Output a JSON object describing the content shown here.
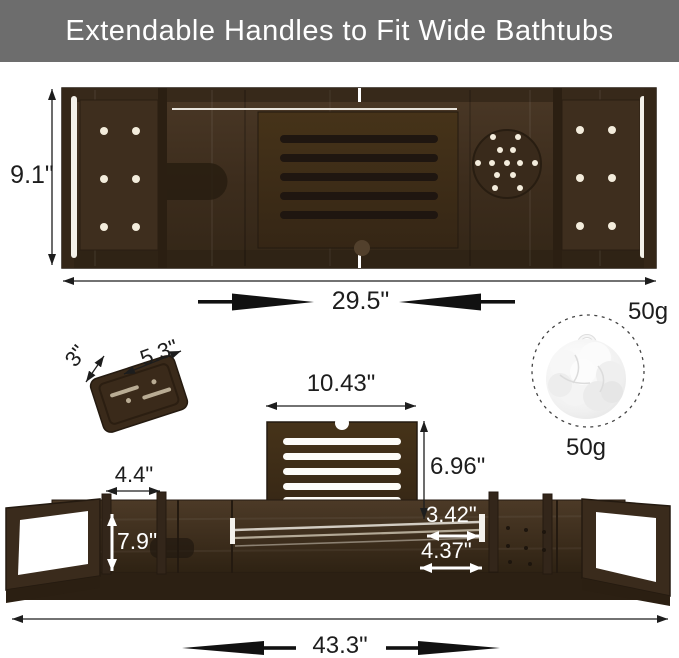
{
  "title": "Extendable Handles to Fit Wide Bathtubs",
  "colors": {
    "banner_bg": "#6d6d6d",
    "wood_dark": "#3f2f1f",
    "wood_shadow": "#241a10",
    "annotation_black": "#1d1d1d",
    "annotation_white": "#ffffff"
  },
  "top_view": {
    "height": "9.1\"",
    "width": "29.5\""
  },
  "soap_dish": {
    "depth": "3\"",
    "width": "5.3\""
  },
  "sponge": {
    "weight_top": "50g",
    "weight_bottom": "50g"
  },
  "bottom_view": {
    "book_rest_width": "10.43\"",
    "book_rest_height": "6.96\"",
    "rack_slot_width": "4.4\"",
    "tray_depth": "7.9\"",
    "gap_small": "3.42\"",
    "gap_large": "4.37\"",
    "total_width": "43.3\""
  }
}
